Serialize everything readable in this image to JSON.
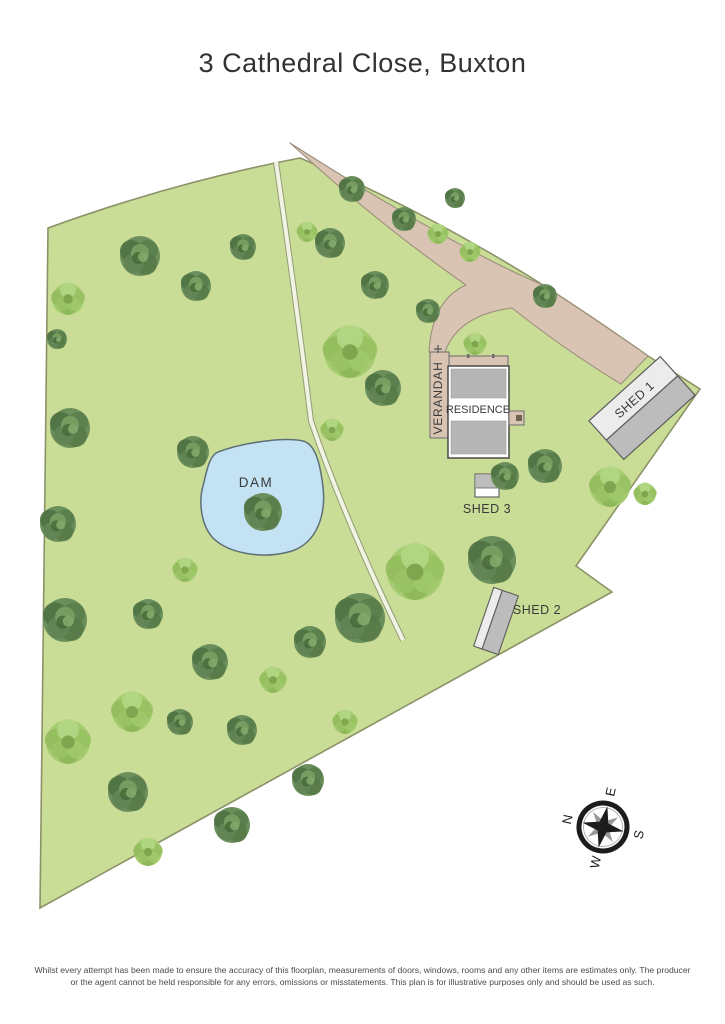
{
  "page": {
    "title": "3 Cathedral Close, Buxton",
    "disclaimer": "Whilst every attempt has been made to ensure the accuracy of this floorplan, measurements of doors, windows, rooms and any other items are estimates only. The producer or the agent cannot be held responsible for any errors, omissions or misstatements. This plan is for illustrative purposes only and should be used as such."
  },
  "site": {
    "labels": {
      "dam": "DAM",
      "residence": "RESIDENCE",
      "verandah": "VERANDAH",
      "shed1": "SHED 1",
      "shed2": "SHED 2",
      "shed3": "SHED 3"
    },
    "compass": {
      "points": [
        "N",
        "E",
        "S",
        "W"
      ],
      "rotation_deg": -78
    },
    "colors": {
      "grass": "#cadd96",
      "boundary": "#8b9268",
      "driveway": "#d9c4b3",
      "driveway_border": "#9c8e7c",
      "water": "#c3e2f3",
      "water_border": "#5d6f77",
      "track": "#f1f3e3",
      "track_border": "#949c78",
      "roof_gray": "#b5b5b5",
      "building_border": "#4a4a4a",
      "structure_tan": "#d9c4b3",
      "shed_gray": "#bcbcbc",
      "shed_light": "#ececec",
      "shed_border": "#5c5c5c",
      "text": "#3a3a3a",
      "compass_dark": "#1c1c1c",
      "compass_gray": "#9a9a9a"
    },
    "trees": [
      {
        "x": 140,
        "y": 256,
        "r": 20,
        "type": "d"
      },
      {
        "x": 196,
        "y": 286,
        "r": 15,
        "type": "d"
      },
      {
        "x": 243,
        "y": 247,
        "r": 13,
        "type": "d"
      },
      {
        "x": 68,
        "y": 299,
        "r": 16,
        "type": "p"
      },
      {
        "x": 57,
        "y": 339,
        "r": 10,
        "type": "d"
      },
      {
        "x": 352,
        "y": 189,
        "r": 13,
        "type": "d"
      },
      {
        "x": 404,
        "y": 219,
        "r": 12,
        "type": "d"
      },
      {
        "x": 438,
        "y": 234,
        "r": 10,
        "type": "p"
      },
      {
        "x": 470,
        "y": 252,
        "r": 10,
        "type": "p"
      },
      {
        "x": 545,
        "y": 296,
        "r": 12,
        "type": "d"
      },
      {
        "x": 330,
        "y": 243,
        "r": 15,
        "type": "d"
      },
      {
        "x": 307,
        "y": 232,
        "r": 10,
        "type": "p"
      },
      {
        "x": 375,
        "y": 285,
        "r": 14,
        "type": "d"
      },
      {
        "x": 350,
        "y": 352,
        "r": 26,
        "type": "p"
      },
      {
        "x": 383,
        "y": 388,
        "r": 18,
        "type": "d"
      },
      {
        "x": 428,
        "y": 311,
        "r": 12,
        "type": "d"
      },
      {
        "x": 475,
        "y": 344,
        "r": 11,
        "type": "p"
      },
      {
        "x": 70,
        "y": 428,
        "r": 20,
        "type": "d"
      },
      {
        "x": 193,
        "y": 452,
        "r": 16,
        "type": "d"
      },
      {
        "x": 58,
        "y": 524,
        "r": 18,
        "type": "d"
      },
      {
        "x": 263,
        "y": 512,
        "r": 19,
        "type": "d"
      },
      {
        "x": 332,
        "y": 430,
        "r": 11,
        "type": "p"
      },
      {
        "x": 185,
        "y": 570,
        "r": 12,
        "type": "p"
      },
      {
        "x": 545,
        "y": 466,
        "r": 17,
        "type": "d"
      },
      {
        "x": 505,
        "y": 476,
        "r": 14,
        "type": "d"
      },
      {
        "x": 610,
        "y": 487,
        "r": 20,
        "type": "p"
      },
      {
        "x": 645,
        "y": 494,
        "r": 11,
        "type": "p"
      },
      {
        "x": 492,
        "y": 560,
        "r": 24,
        "type": "d"
      },
      {
        "x": 415,
        "y": 572,
        "r": 28,
        "type": "p"
      },
      {
        "x": 360,
        "y": 618,
        "r": 25,
        "type": "d"
      },
      {
        "x": 310,
        "y": 642,
        "r": 16,
        "type": "d"
      },
      {
        "x": 65,
        "y": 620,
        "r": 22,
        "type": "d"
      },
      {
        "x": 148,
        "y": 614,
        "r": 15,
        "type": "d"
      },
      {
        "x": 210,
        "y": 662,
        "r": 18,
        "type": "d"
      },
      {
        "x": 273,
        "y": 680,
        "r": 13,
        "type": "p"
      },
      {
        "x": 132,
        "y": 712,
        "r": 20,
        "type": "p"
      },
      {
        "x": 242,
        "y": 730,
        "r": 15,
        "type": "d"
      },
      {
        "x": 345,
        "y": 722,
        "r": 12,
        "type": "p"
      },
      {
        "x": 180,
        "y": 722,
        "r": 13,
        "type": "d"
      },
      {
        "x": 68,
        "y": 742,
        "r": 22,
        "type": "p"
      },
      {
        "x": 128,
        "y": 792,
        "r": 20,
        "type": "d"
      },
      {
        "x": 308,
        "y": 780,
        "r": 16,
        "type": "d"
      },
      {
        "x": 232,
        "y": 825,
        "r": 18,
        "type": "d"
      },
      {
        "x": 148,
        "y": 852,
        "r": 14,
        "type": "p"
      },
      {
        "x": 455,
        "y": 198,
        "r": 10,
        "type": "d"
      }
    ]
  }
}
